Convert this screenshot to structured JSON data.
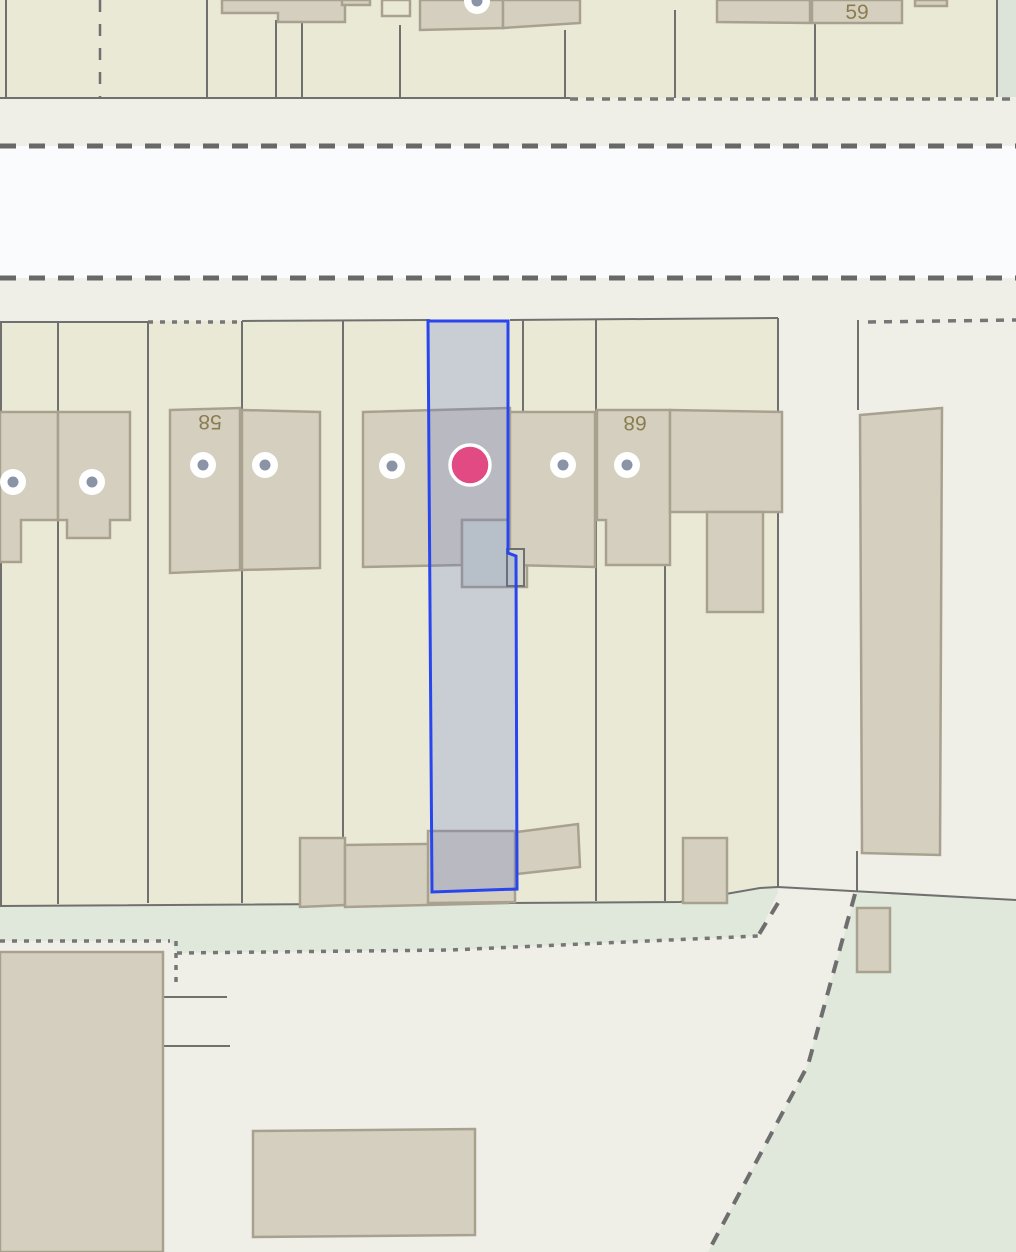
{
  "map": {
    "title": "cadastral-map-view",
    "labels": {
      "h58": "58",
      "h68": "68",
      "h59": "59"
    },
    "label_orientation": {
      "h58": "rotated-180",
      "h68": "rotated-180",
      "h59": "normal"
    },
    "selection": {
      "stroke": "#2946ee",
      "fill_overlay": "rgba(80,110,200,0.22)"
    },
    "marker": {
      "name": "selected-location-marker",
      "color": "#e14a83",
      "ring": "#ffffff"
    },
    "address_points": {
      "count": 8,
      "ring_color": "#ffffff",
      "inner_color": "#8b94a6"
    },
    "palette": {
      "background": "#efeee7",
      "parcel": "#eae9d6",
      "road": "#fafbfd",
      "green": "#dfe8da",
      "green_light": "#dce4da",
      "building": "#d5cfbf",
      "building_stroke": "#a9a190",
      "annex": "#d4d6c9",
      "line": "#70716f",
      "dotted": "#767676",
      "dash": "#686868",
      "label": "#8b7d50",
      "selection_stroke": "#2946ee",
      "selection_fill": "rgba(80,110,200,0.22)",
      "marker": "#e14a83",
      "marker_ring": "#ffffff",
      "addr_ring": "#ffffff",
      "addr_inner": "#8b94a6"
    }
  }
}
